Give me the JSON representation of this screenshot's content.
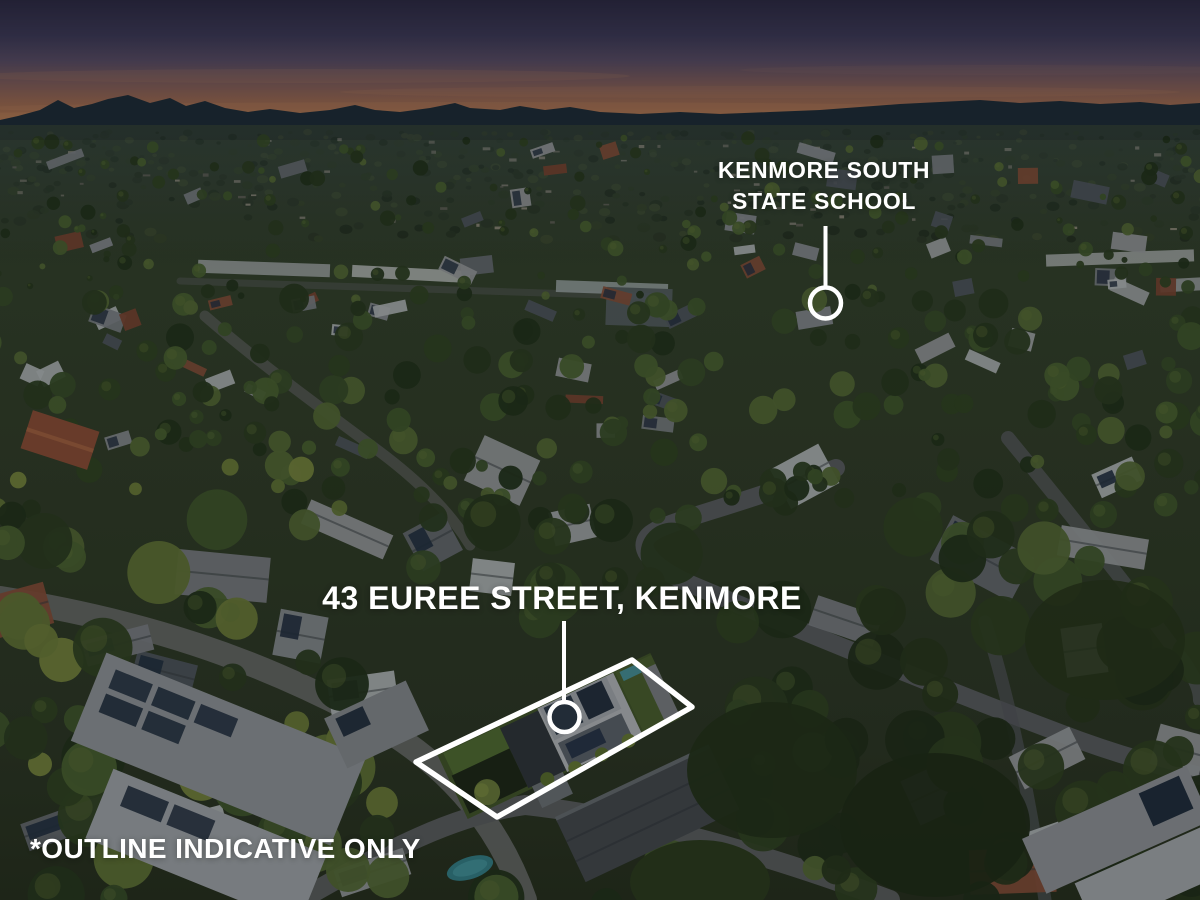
{
  "annotations": {
    "school": {
      "label_line1": "KENMORE SOUTH",
      "label_line2": "STATE SCHOOL"
    },
    "property": {
      "label": "43 EUREE STREET, KENMORE"
    },
    "disclaimer": "*OUTLINE INDICATIVE ONLY",
    "marker_color": "#ffffff"
  }
}
